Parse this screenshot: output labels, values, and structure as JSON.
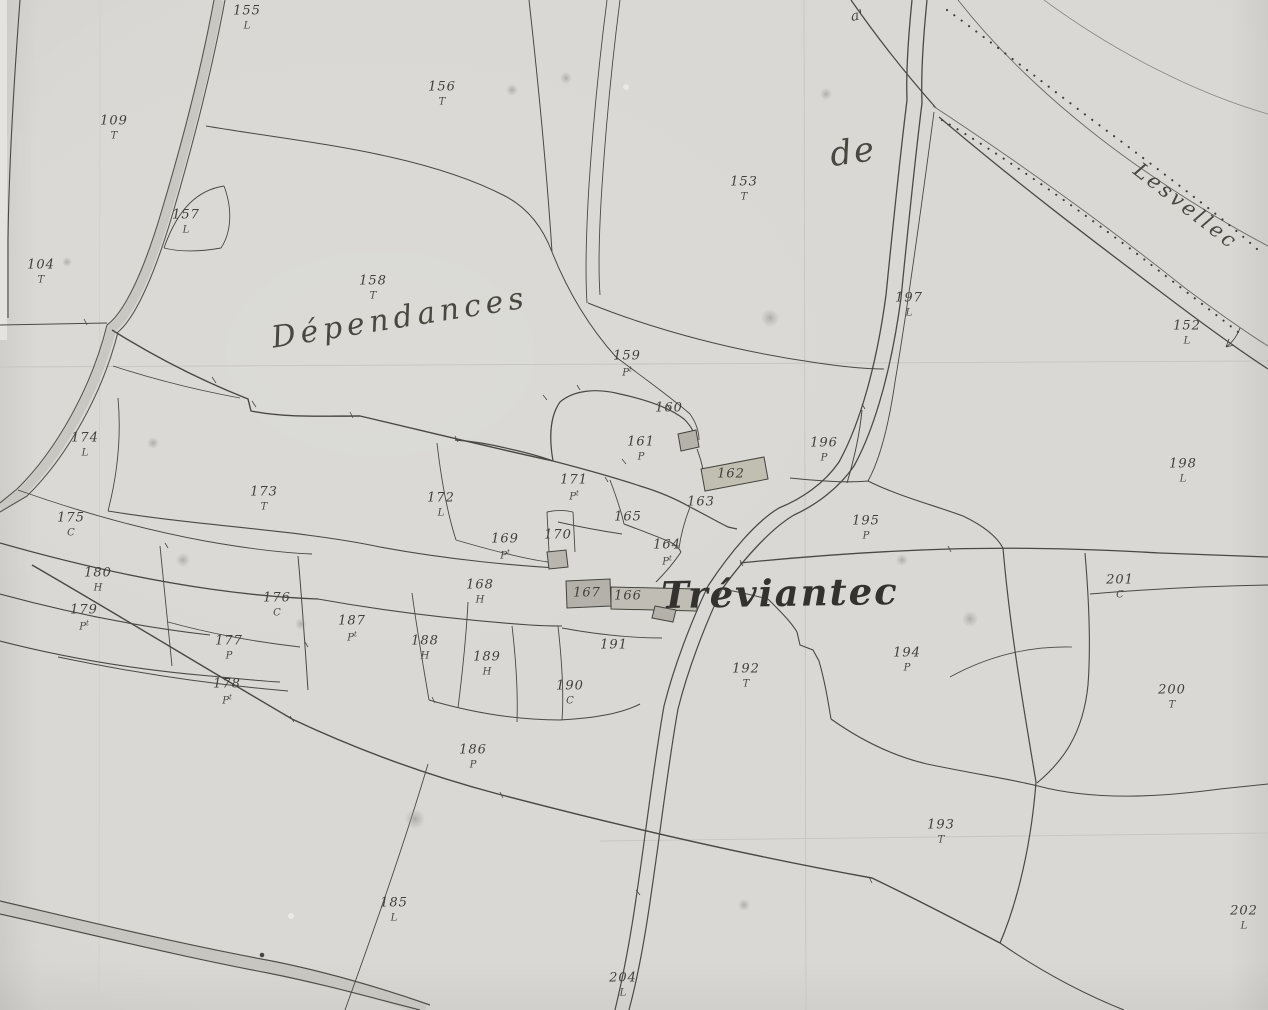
{
  "map": {
    "description": "Old hand-drawn cadastral map sheet (scanned, grayscale) showing numbered land parcels, roads and a village",
    "colors": {
      "paper": "#d9d8d4",
      "ink": "#44423e",
      "road_fill": "#c8c7c2",
      "building_fill": "#b6b4ac",
      "building_fill_warm": "#c1beb2",
      "faint_line": "#c6c5c1"
    },
    "place_labels": [
      {
        "id": "dependances",
        "text": "Dépendances",
        "x": 400,
        "y": 318,
        "rotation": -9,
        "size": 30,
        "spacing": 5,
        "style": "script"
      },
      {
        "id": "de",
        "text": "de",
        "x": 853,
        "y": 152,
        "rotation": -8,
        "size": 34,
        "spacing": 2,
        "style": "script"
      },
      {
        "id": "lesvellec",
        "text": "Lesvellec",
        "x": 1186,
        "y": 206,
        "rotation": 38,
        "size": 21,
        "spacing": 3,
        "style": "script"
      },
      {
        "id": "treviantec",
        "text": "Tréviantec",
        "x": 780,
        "y": 593,
        "rotation": -1,
        "size": 37,
        "spacing": 2,
        "style": "bold"
      },
      {
        "id": "road-mark",
        "text": "a'",
        "x": 857,
        "y": 16,
        "rotation": -10,
        "size": 14,
        "spacing": 0,
        "style": "script"
      }
    ],
    "parcel_labels": [
      {
        "n": "155",
        "l": "L",
        "x": 247,
        "y": 10
      },
      {
        "n": "156",
        "l": "T",
        "x": 442,
        "y": 86
      },
      {
        "n": "109",
        "l": "T",
        "x": 114,
        "y": 120
      },
      {
        "n": "153",
        "l": "T",
        "x": 744,
        "y": 181
      },
      {
        "n": "157",
        "l": "L",
        "x": 186,
        "y": 214
      },
      {
        "n": "104",
        "l": "T",
        "x": 41,
        "y": 264
      },
      {
        "n": "158",
        "l": "T",
        "x": 373,
        "y": 280
      },
      {
        "n": "197",
        "l": "L",
        "x": 909,
        "y": 297
      },
      {
        "n": "152",
        "l": "L",
        "x": 1187,
        "y": 325
      },
      {
        "n": "159",
        "l": "Pt",
        "x": 627,
        "y": 356
      },
      {
        "n": "174",
        "l": "L",
        "x": 85,
        "y": 437
      },
      {
        "n": "160",
        "l": "",
        "x": 669,
        "y": 408
      },
      {
        "n": "161",
        "l": "P",
        "x": 641,
        "y": 441
      },
      {
        "n": "196",
        "l": "P",
        "x": 824,
        "y": 442
      },
      {
        "n": "198",
        "l": "L",
        "x": 1183,
        "y": 463
      },
      {
        "n": "162",
        "l": "",
        "x": 731,
        "y": 474
      },
      {
        "n": "173",
        "l": "T",
        "x": 264,
        "y": 491
      },
      {
        "n": "172",
        "l": "L",
        "x": 441,
        "y": 497
      },
      {
        "n": "171",
        "l": "Pt",
        "x": 574,
        "y": 480
      },
      {
        "n": "163",
        "l": "",
        "x": 701,
        "y": 502
      },
      {
        "n": "165",
        "l": "",
        "x": 628,
        "y": 517
      },
      {
        "n": "195",
        "l": "P",
        "x": 866,
        "y": 520
      },
      {
        "n": "170",
        "l": "",
        "x": 558,
        "y": 535
      },
      {
        "n": "169",
        "l": "Pt",
        "x": 505,
        "y": 539
      },
      {
        "n": "164",
        "l": "Pt",
        "x": 667,
        "y": 545
      },
      {
        "n": "175",
        "l": "C",
        "x": 71,
        "y": 517
      },
      {
        "n": "201",
        "l": "C",
        "x": 1120,
        "y": 579
      },
      {
        "n": "168",
        "l": "H",
        "x": 480,
        "y": 584
      },
      {
        "n": "167",
        "l": "",
        "x": 587,
        "y": 593
      },
      {
        "n": "166",
        "l": "",
        "x": 628,
        "y": 596
      },
      {
        "n": "180",
        "l": "H",
        "x": 98,
        "y": 572
      },
      {
        "n": "176",
        "l": "C",
        "x": 277,
        "y": 597
      },
      {
        "n": "179",
        "l": "Pt",
        "x": 84,
        "y": 610
      },
      {
        "n": "187",
        "l": "Pt",
        "x": 352,
        "y": 621
      },
      {
        "n": "177",
        "l": "P",
        "x": 229,
        "y": 640
      },
      {
        "n": "188",
        "l": "H",
        "x": 425,
        "y": 640
      },
      {
        "n": "189",
        "l": "H",
        "x": 487,
        "y": 656
      },
      {
        "n": "191",
        "l": "",
        "x": 614,
        "y": 645
      },
      {
        "n": "192",
        "l": "T",
        "x": 746,
        "y": 668
      },
      {
        "n": "194",
        "l": "P",
        "x": 907,
        "y": 652
      },
      {
        "n": "178",
        "l": "Pt",
        "x": 227,
        "y": 684
      },
      {
        "n": "190",
        "l": "C",
        "x": 570,
        "y": 685
      },
      {
        "n": "200",
        "l": "T",
        "x": 1172,
        "y": 689
      },
      {
        "n": "186",
        "l": "P",
        "x": 473,
        "y": 749
      },
      {
        "n": "193",
        "l": "T",
        "x": 941,
        "y": 824
      },
      {
        "n": "185",
        "l": "L",
        "x": 394,
        "y": 902
      },
      {
        "n": "202",
        "l": "L",
        "x": 1244,
        "y": 910
      },
      {
        "n": "204",
        "l": "L",
        "x": 623,
        "y": 977
      }
    ]
  }
}
